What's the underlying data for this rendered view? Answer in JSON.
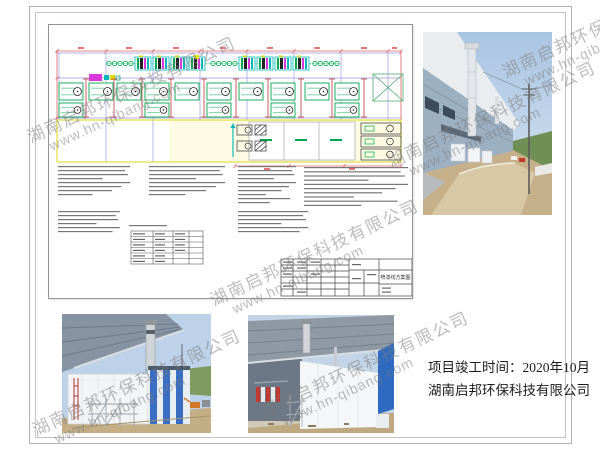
{
  "page": {
    "background": "#ffffff",
    "frame_color": "#b2b2b2"
  },
  "drawing": {
    "title_block_title": "喷漆线方案图",
    "colors": {
      "unit_outline_green": "#00a651",
      "dimension_red": "#e06060",
      "grid_purple": "#8f8fd8",
      "strip_cyan": "#00b6b6",
      "strip_magenta": "#d838d8",
      "zone_yellow": "#ddd816"
    }
  },
  "caption": {
    "line1": "项目竣工时间：2020年10月",
    "line2": "湖南启邦环保科技有限公司"
  },
  "watermark": {
    "line1": "湖南启邦环保科技有限公司",
    "line2": "www.hn-qibang.com",
    "color": "#7a7a7a"
  },
  "photos": {
    "sky_blue": "#b5cce6",
    "dirt_tan": "#c6b08a",
    "equipment_blue": "#3a6ec2",
    "sign_blue": "#2e6bc0"
  }
}
